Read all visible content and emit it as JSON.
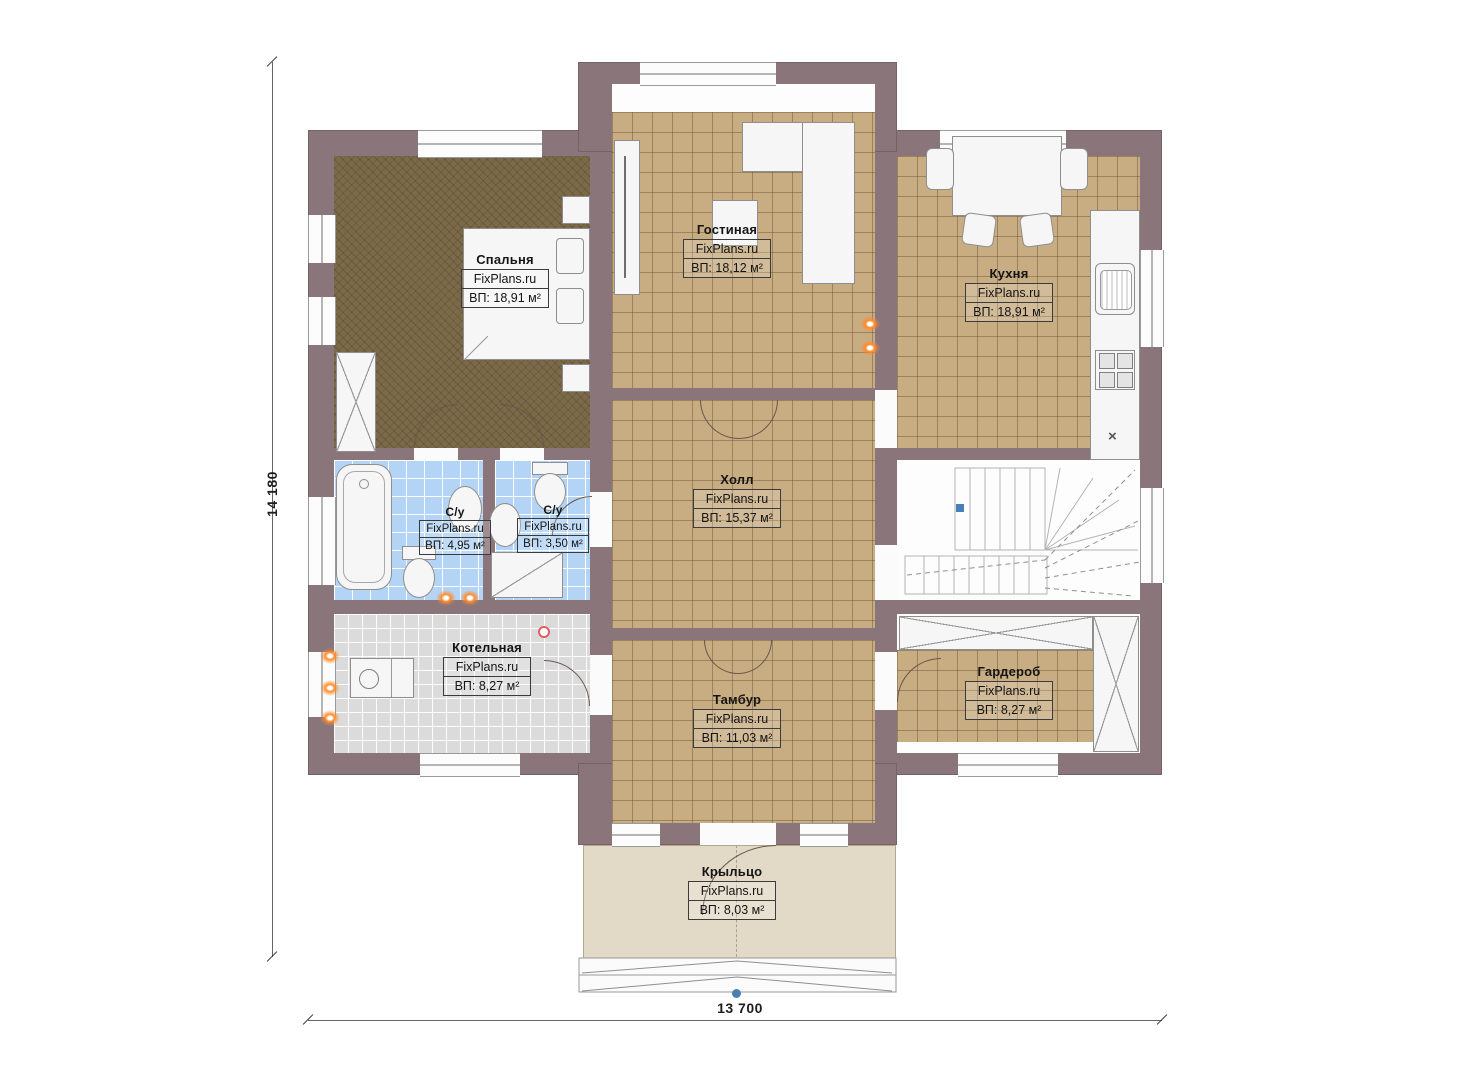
{
  "plan": {
    "brand_watermark": "FixPlans.ru",
    "dimensions": {
      "vertical": "14 180",
      "horizontal": "13 700"
    },
    "kitchen_mark": "×",
    "rooms": [
      {
        "id": "bedroom",
        "name": "Спальня",
        "brand": "FixPlans.ru",
        "area": "ВП: 18,91 м²"
      },
      {
        "id": "living-room",
        "name": "Гостиная",
        "brand": "FixPlans.ru",
        "area": "ВП: 18,12 м²"
      },
      {
        "id": "kitchen",
        "name": "Кухня",
        "brand": "FixPlans.ru",
        "area": "ВП: 18,91 м²"
      },
      {
        "id": "hall",
        "name": "Холл",
        "brand": "FixPlans.ru",
        "area": "ВП: 15,37 м²"
      },
      {
        "id": "bathroom-1",
        "name": "С/у",
        "brand": "FixPlans.ru",
        "area": "ВП: 4,95 м²"
      },
      {
        "id": "bathroom-2",
        "name": "С/у",
        "brand": "FixPlans.ru",
        "area": "ВП: 3,50 м²"
      },
      {
        "id": "boiler-room",
        "name": "Котельная",
        "brand": "FixPlans.ru",
        "area": "ВП: 8,27 м²"
      },
      {
        "id": "vestibule",
        "name": "Тамбур",
        "brand": "FixPlans.ru",
        "area": "ВП: 11,03 м²"
      },
      {
        "id": "wardrobe",
        "name": "Гардероб",
        "brand": "FixPlans.ru",
        "area": "ВП: 8,27 м²"
      },
      {
        "id": "porch",
        "name": "Крыльцо",
        "brand": "FixPlans.ru",
        "area": "ВП: 8,03 м²"
      }
    ],
    "colors": {
      "wall": "#8a757b",
      "floor_tan": "#c8ad82",
      "floor_bedroom": "#7b6948",
      "tile_blue": "#b3d4f4",
      "tile_gray": "#dbdbdb",
      "porch": "#e3d9c7",
      "radiator_orange": "#ff8a2a",
      "fixture_white": "#f6f6f6",
      "reference_blue": "#4a7fb5"
    }
  }
}
